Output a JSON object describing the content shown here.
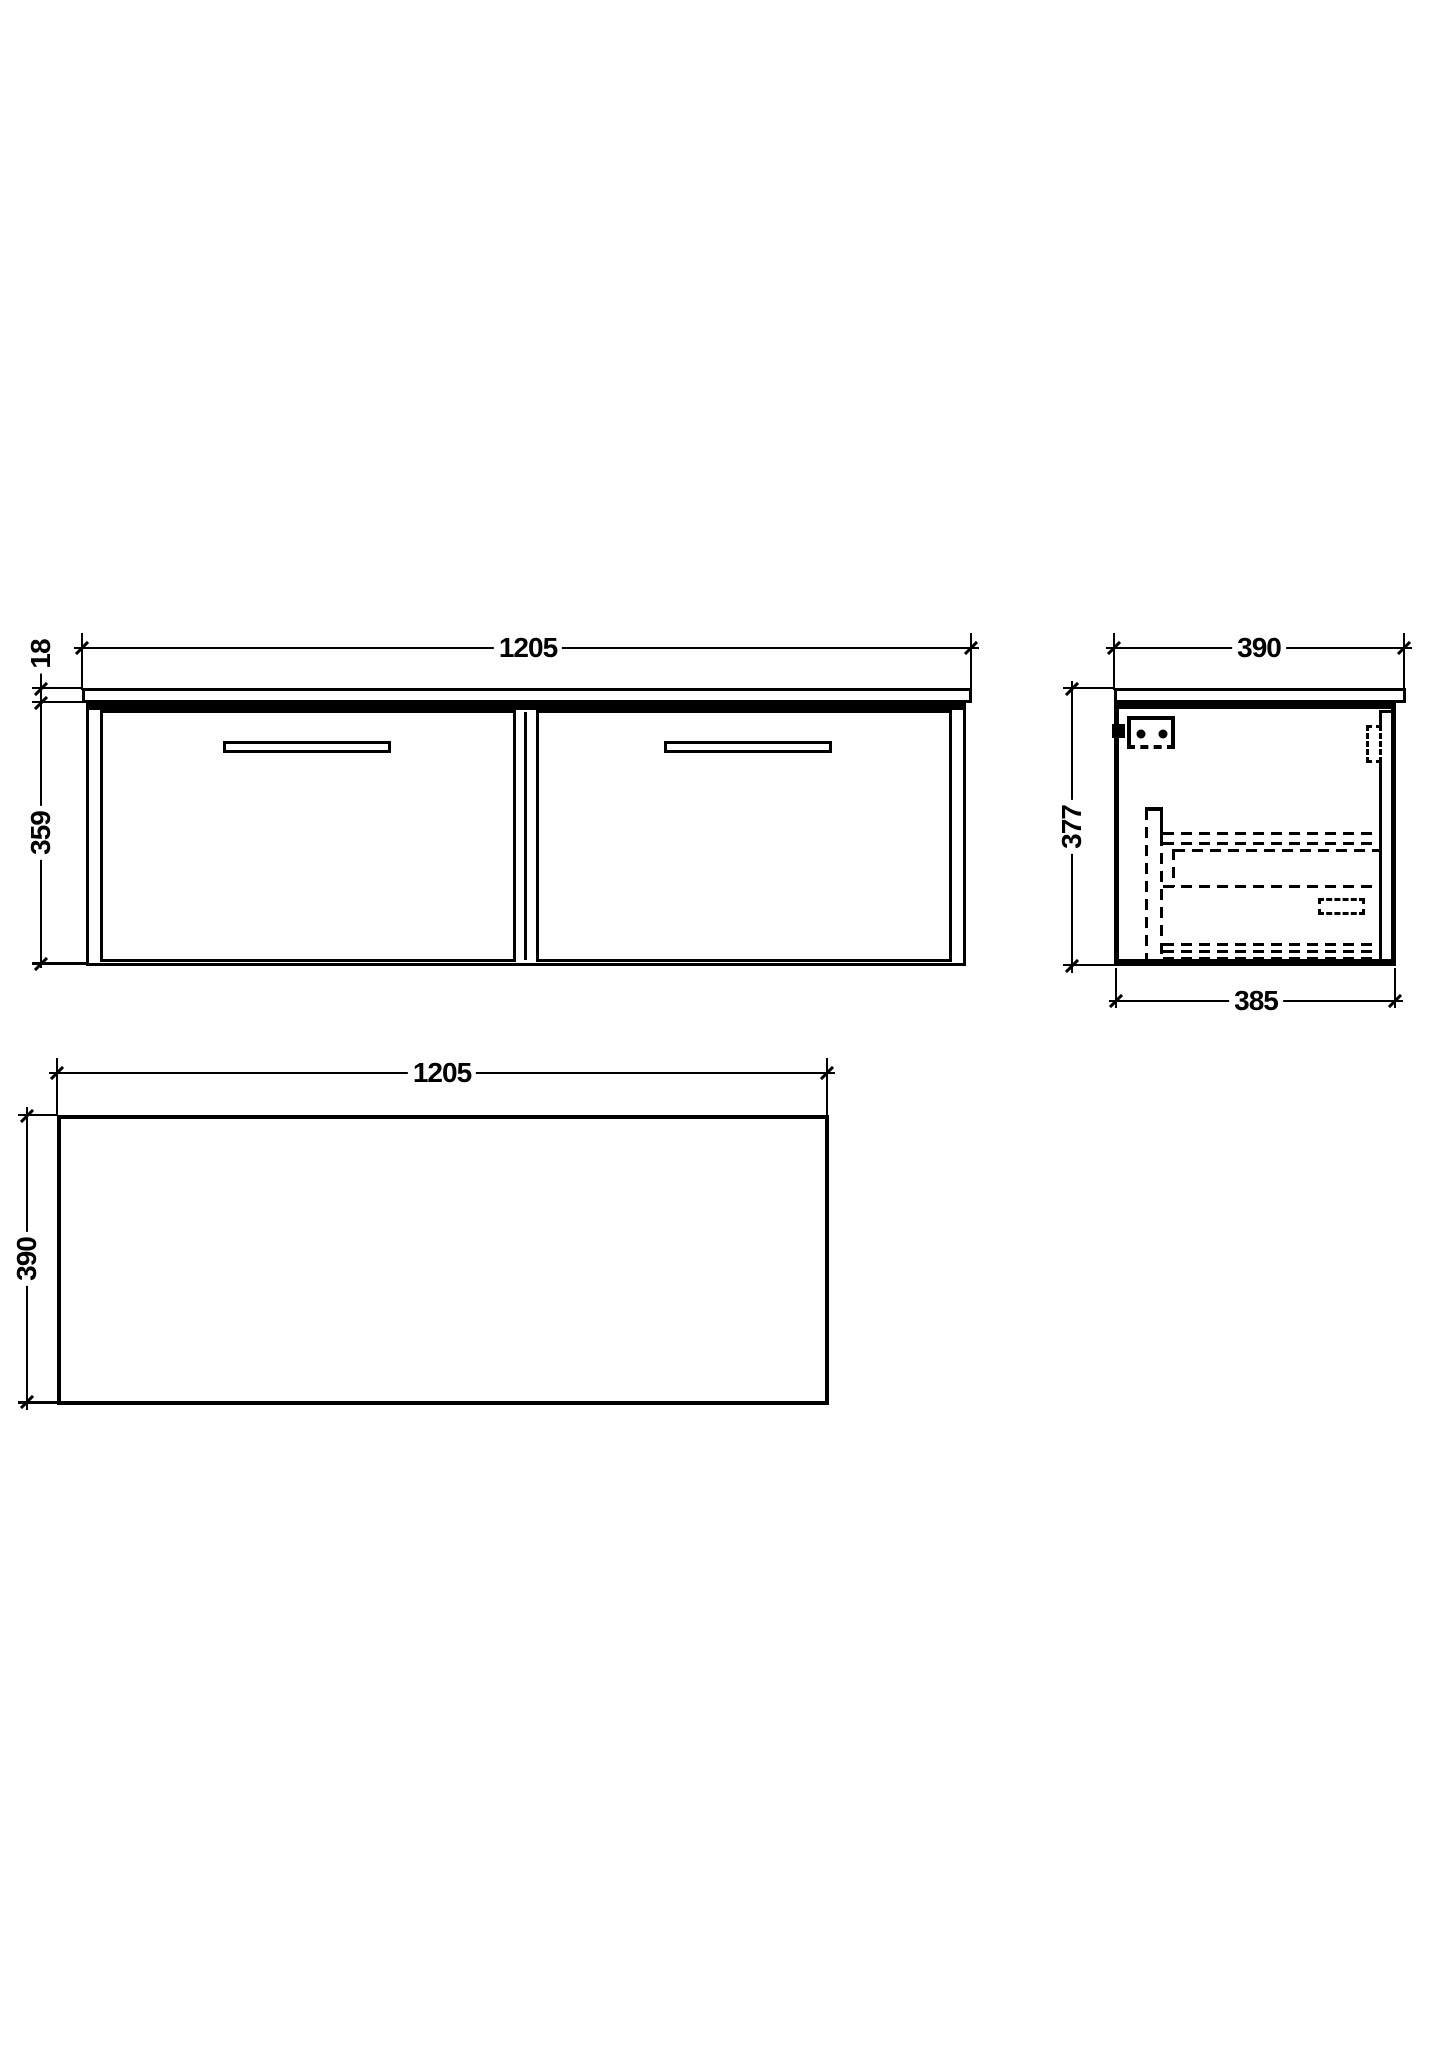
{
  "drawing": {
    "colors": {
      "line": "#000000",
      "background": "#ffffff"
    },
    "views": {
      "front": {
        "width_mm": "1205",
        "countertop_thickness_mm": "18",
        "cabinet_height_mm": "359"
      },
      "side": {
        "depth_mm": "390",
        "height_mm": "377",
        "carcass_depth_mm": "385"
      },
      "plan": {
        "width_mm": "1205",
        "depth_mm": "390"
      }
    }
  }
}
